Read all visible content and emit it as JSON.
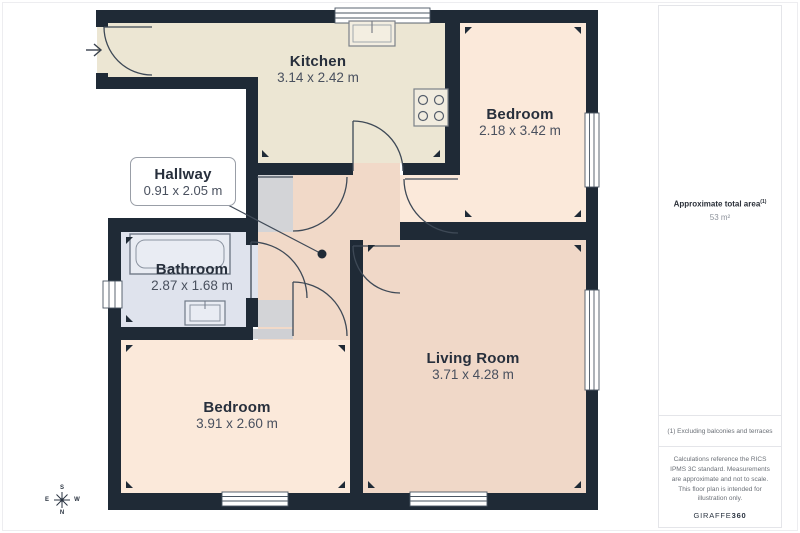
{
  "floorplan": {
    "rooms": [
      {
        "name": "Kitchen",
        "dims": "3.14 x 2.42 m"
      },
      {
        "name": "Bedroom",
        "dims": "2.18 x 3.42 m"
      },
      {
        "name": "Hallway",
        "dims": "0.91 x 2.05 m"
      },
      {
        "name": "Bathroom",
        "dims": "2.87 x 1.68 m"
      },
      {
        "name": "Bedroom",
        "dims": "3.91 x 2.60 m"
      },
      {
        "name": "Living Room",
        "dims": "3.71 x 4.28 m"
      }
    ],
    "compass": {
      "n": "N",
      "s": "S",
      "e": "E",
      "w": "W"
    },
    "colors": {
      "wall": "#1f2a36",
      "kitchen": "#ece6d3",
      "bedroom": "#fbe9da",
      "living_room": "#f0d8c8",
      "hallway": "#f1d9c8",
      "bathroom": "#dfe3ed",
      "closet_grey": "#d3d4d7"
    }
  },
  "sidebar": {
    "total_area_label": "Approximate total area",
    "total_area_superscript": "(1)",
    "total_area_value": "53 m²",
    "footnote": "(1) Excluding balconies and terraces",
    "disclaimer": "Calculations reference the RICS IPMS 3C standard. Measurements are approximate and not to scale. This floor plan is intended for illustration only.",
    "brand_name": "GIRAFFE",
    "brand_suffix": "360"
  }
}
